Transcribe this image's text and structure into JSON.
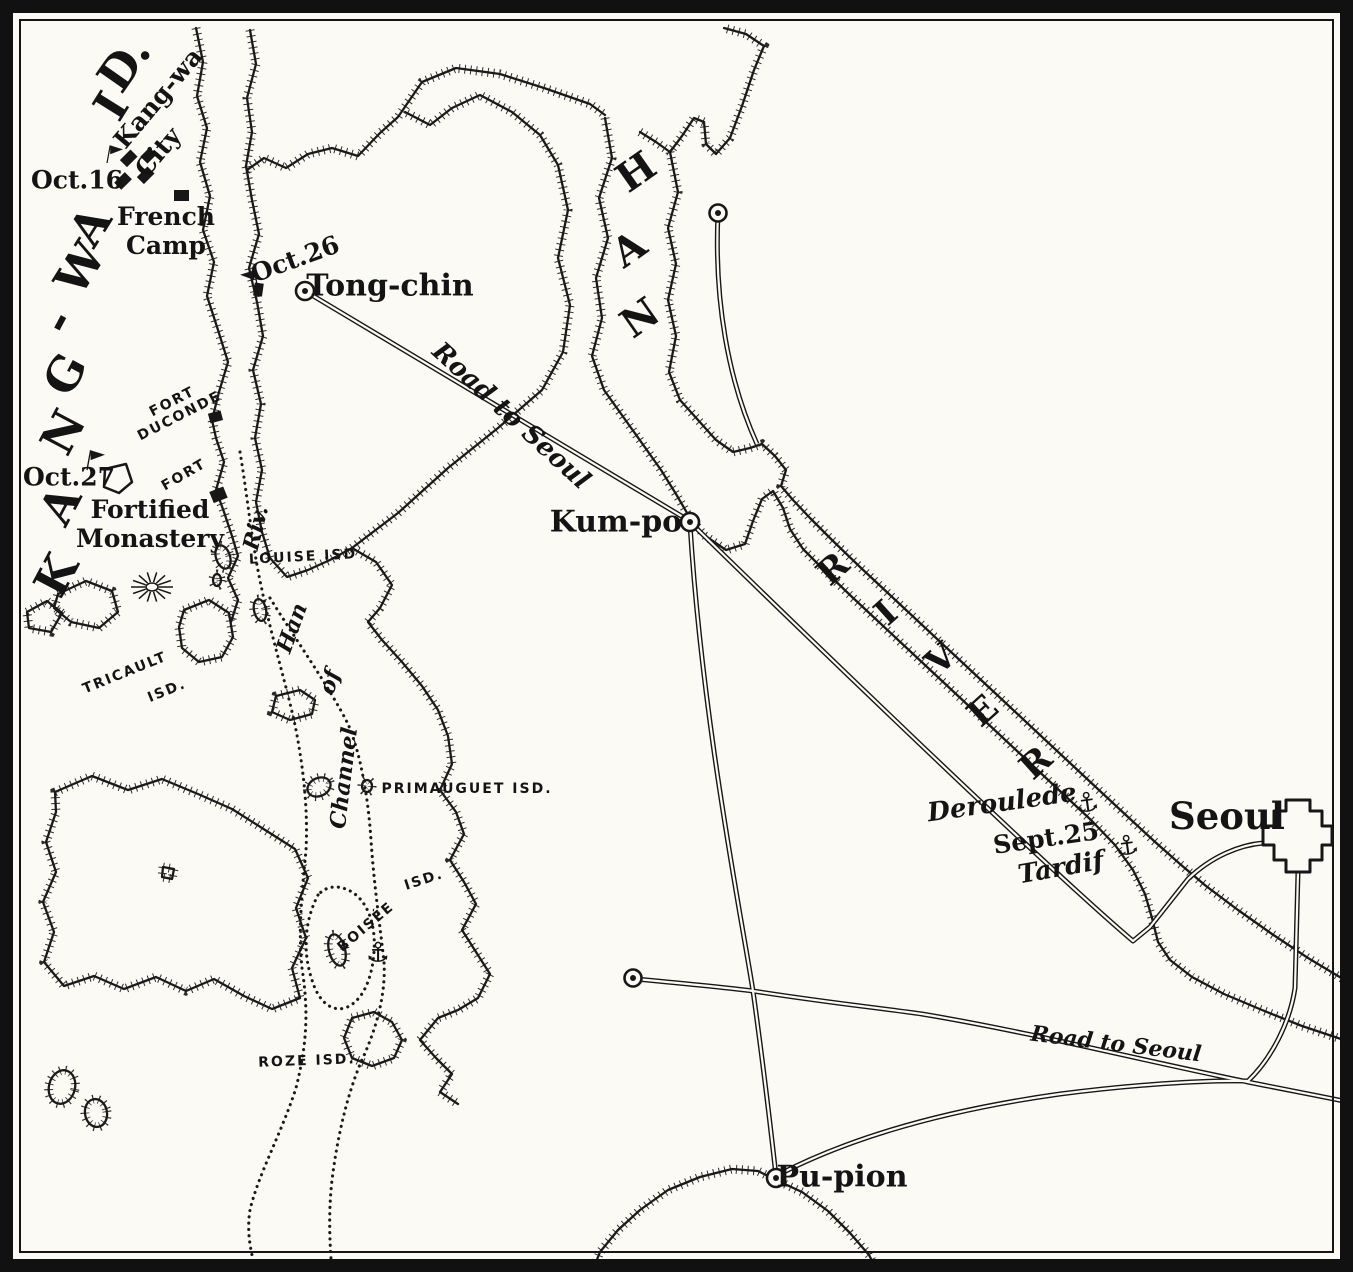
{
  "map": {
    "type": "historical-engraved-map",
    "region": "Kang-wa Island, Han River and approaches to Seoul",
    "colors": {
      "paper": "#fcfaf4",
      "ink": "#171717"
    },
    "symbols": {
      "anchor_glyph": "⚓",
      "town_marker": "circled-dot",
      "camp_marker": "black-square",
      "flag_marker": "pennant-flag"
    }
  },
  "labels": [
    {
      "name": "island-letter-k",
      "text": "K",
      "x": 56,
      "y": 575,
      "rot": -62,
      "cls": "bigletter"
    },
    {
      "name": "island-letter-a1",
      "text": "A",
      "x": 60,
      "y": 505,
      "rot": -62,
      "cls": "bigletter"
    },
    {
      "name": "island-letter-n",
      "text": "N",
      "x": 63,
      "y": 432,
      "rot": -62,
      "cls": "bigletter"
    },
    {
      "name": "island-letter-g",
      "text": "G",
      "x": 65,
      "y": 374,
      "rot": -62,
      "cls": "bigletter"
    },
    {
      "name": "island-letter-hyphen",
      "text": "-",
      "x": 57,
      "y": 321,
      "rot": -62,
      "cls": "bigletter"
    },
    {
      "name": "island-letter-w",
      "text": "W",
      "x": 80,
      "y": 268,
      "rot": -58,
      "cls": "bigletter"
    },
    {
      "name": "island-letter-a2",
      "text": "A",
      "x": 90,
      "y": 226,
      "rot": -58,
      "cls": "bigletter"
    },
    {
      "name": "island-letter-i",
      "text": "I",
      "x": 111,
      "y": 106,
      "rot": -58,
      "cls": "bigletter"
    },
    {
      "name": "island-letter-d",
      "text": "D.",
      "x": 124,
      "y": 64,
      "rot": -55,
      "cls": "bigletter"
    },
    {
      "name": "han-letter-h",
      "text": "H",
      "x": 636,
      "y": 172,
      "rot": -35,
      "cls": "hanletter"
    },
    {
      "name": "han-letter-a",
      "text": "A",
      "x": 629,
      "y": 249,
      "rot": -35,
      "cls": "hanletter"
    },
    {
      "name": "han-letter-n",
      "text": "N",
      "x": 640,
      "y": 318,
      "rot": -35,
      "cls": "hanletter"
    },
    {
      "name": "river-letter-r1",
      "text": "R",
      "x": 833,
      "y": 569,
      "rot": -42,
      "cls": "riverletter"
    },
    {
      "name": "river-letter-i",
      "text": "I",
      "x": 886,
      "y": 613,
      "rot": -42,
      "cls": "riverletter"
    },
    {
      "name": "river-letter-v",
      "text": "V",
      "x": 941,
      "y": 659,
      "rot": -42,
      "cls": "riverletter"
    },
    {
      "name": "river-letter-e",
      "text": "E",
      "x": 983,
      "y": 711,
      "rot": -42,
      "cls": "riverletter"
    },
    {
      "name": "river-letter-r2",
      "text": "R",
      "x": 1036,
      "y": 763,
      "rot": -42,
      "cls": "riverletter"
    },
    {
      "name": "label-kangwa-city-1",
      "text": "Kang-wa",
      "x": 158,
      "y": 98,
      "rot": -50,
      "cls": "place"
    },
    {
      "name": "label-kangwa-city-2",
      "text": "City",
      "x": 158,
      "y": 152,
      "rot": -50,
      "cls": "place"
    },
    {
      "name": "label-oct16",
      "text": "Oct.16",
      "x": 77,
      "y": 180,
      "rot": 0,
      "cls": "place"
    },
    {
      "name": "label-french-camp",
      "text": "French\nCamp",
      "x": 166,
      "y": 231,
      "rot": 0,
      "cls": "place"
    },
    {
      "name": "label-oct26",
      "text": "Oct.26",
      "x": 295,
      "y": 259,
      "rot": -20,
      "cls": "place"
    },
    {
      "name": "label-tong-chin",
      "text": "Tong-chin",
      "x": 390,
      "y": 286,
      "rot": 0,
      "cls": "town"
    },
    {
      "name": "label-fort-duconde",
      "text": "FORT\nDUCONDE",
      "x": 176,
      "y": 409,
      "rot": -27,
      "cls": "isd"
    },
    {
      "name": "label-fort",
      "text": "FORT",
      "x": 184,
      "y": 475,
      "rot": -30,
      "cls": "isd"
    },
    {
      "name": "label-oct27",
      "text": "Oct.27",
      "x": 69,
      "y": 477,
      "rot": 0,
      "cls": "place"
    },
    {
      "name": "label-fortified-monastery",
      "text": "Fortified\nMonastery",
      "x": 150,
      "y": 524,
      "rot": 0,
      "cls": "place"
    },
    {
      "name": "label-louise-isd",
      "text": "LOUISE ISD",
      "x": 303,
      "y": 557,
      "rot": -3,
      "cls": "isd"
    },
    {
      "name": "label-tricault",
      "text": "TRICAULT",
      "x": 125,
      "y": 673,
      "rot": -22,
      "cls": "isd"
    },
    {
      "name": "label-tricault-isd",
      "text": "ISD.",
      "x": 167,
      "y": 691,
      "rot": -22,
      "cls": "isd"
    },
    {
      "name": "label-primauguet-isd",
      "text": "PRIMAUGUET ISD.",
      "x": 467,
      "y": 789,
      "rot": 0,
      "cls": "isd"
    },
    {
      "name": "label-boisee",
      "text": "BOISÉE",
      "x": 366,
      "y": 927,
      "rot": -40,
      "cls": "isd"
    },
    {
      "name": "label-boisee-isd",
      "text": "ISD.",
      "x": 424,
      "y": 880,
      "rot": -18,
      "cls": "isd"
    },
    {
      "name": "label-roze-isd",
      "text": "ROZE ISD.",
      "x": 307,
      "y": 1061,
      "rot": -2,
      "cls": "isd"
    },
    {
      "name": "label-channel",
      "text": "Channel",
      "x": 344,
      "y": 778,
      "rot": -83,
      "cls": "itsm"
    },
    {
      "name": "label-of",
      "text": "of",
      "x": 330,
      "y": 682,
      "rot": -72,
      "cls": "itsm"
    },
    {
      "name": "label-han-word",
      "text": "Han",
      "x": 292,
      "y": 628,
      "rot": -70,
      "cls": "itsm"
    },
    {
      "name": "label-riv",
      "text": "Riv.",
      "x": 256,
      "y": 528,
      "rot": -76,
      "cls": "itsm"
    },
    {
      "name": "label-road-to-seoul-1",
      "text": "Road to Seoul",
      "x": 511,
      "y": 416,
      "rot": 42.5,
      "cls": "ital"
    },
    {
      "name": "label-kum-po",
      "text": "Kum-po",
      "x": 616,
      "y": 522,
      "rot": 0,
      "cls": "town"
    },
    {
      "name": "label-deroulede",
      "text": "Deroulede",
      "x": 1002,
      "y": 803,
      "rot": -8,
      "cls": "ital"
    },
    {
      "name": "label-sept25",
      "text": "Sept.25",
      "x": 1046,
      "y": 838,
      "rot": -8,
      "cls": "place"
    },
    {
      "name": "label-tardif",
      "text": "Tardif",
      "x": 1061,
      "y": 868,
      "rot": -10,
      "cls": "ital"
    },
    {
      "name": "label-seoul",
      "text": "Seoul",
      "x": 1227,
      "y": 816,
      "rot": 0,
      "cls": "seoultxt"
    },
    {
      "name": "label-road-to-seoul-2",
      "text": "Road to Seoul",
      "x": 1116,
      "y": 1044,
      "rot": 7,
      "cls": "itsm"
    },
    {
      "name": "label-pu-pion",
      "text": "Pu-pion",
      "x": 842,
      "y": 1177,
      "rot": 0,
      "cls": "town"
    },
    {
      "name": "anchor-deroulede-icon",
      "text": "⚓",
      "x": 1087,
      "y": 803,
      "rot": -8,
      "cls": "anchor"
    },
    {
      "name": "anchor-tardif-icon",
      "text": "⚓",
      "x": 1127,
      "y": 846,
      "rot": -8,
      "cls": "anchor"
    },
    {
      "name": "anchor-boisee-icon",
      "text": "⚓",
      "x": 378,
      "y": 953,
      "rot": 0,
      "cls": "anchor"
    }
  ]
}
